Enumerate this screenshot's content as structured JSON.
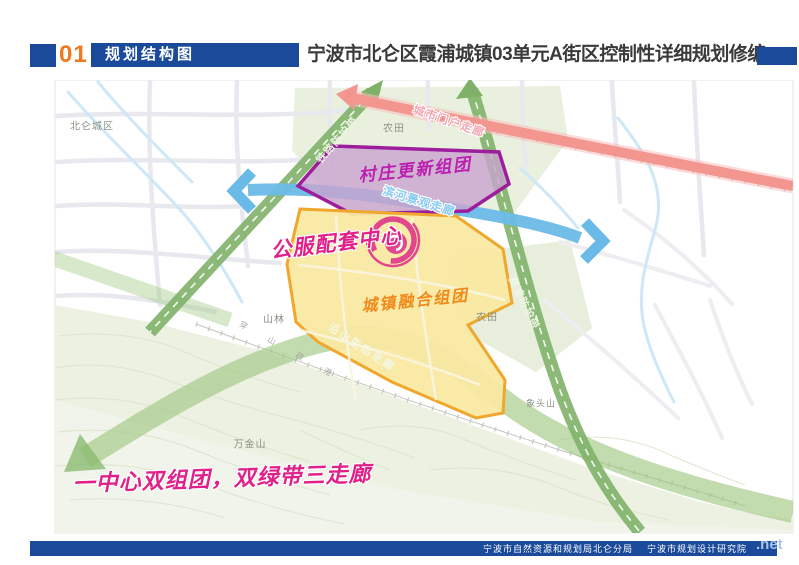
{
  "header": {
    "index_number": "01",
    "section_title": "规划结构图",
    "main_title": "宁波市北仑区霞浦城镇03单元A街区控制性详细规划修编"
  },
  "map": {
    "region_labels": {
      "beilun": "北仑城区",
      "farmland_north": "农田",
      "farmland_east": "农田",
      "forest": "山林",
      "wanjinshan": "万金山",
      "xiangtoushan": "象头山",
      "port_road": "穿山疏港"
    },
    "zones": {
      "village_renewal": {
        "label": "村庄更新组团",
        "fill": "#C9A2CE",
        "border": "#9C1E9C"
      },
      "town_integration": {
        "label": "城镇融合组团",
        "fill": "#F9E9A2",
        "border": "#F0A72E"
      },
      "public_service_center": {
        "label": "公服配套中心",
        "color": "#E0218A"
      }
    },
    "corridors": {
      "city_gateway": {
        "label": "城市门户走廊",
        "color": "#F2968F"
      },
      "riverside": {
        "label": "滨河景观走廊",
        "color": "#6ABAE8"
      },
      "railway_buffer": {
        "label": "铁路防护带",
        "color": "#7FB169"
      },
      "expressway_buffer": {
        "label": "高速防护带",
        "color": "#7FB169"
      },
      "mountain_eco": {
        "label": "沿山生态走廊",
        "color": "#9CC57E"
      }
    },
    "slogan": "一中心双组团，双绿带三走廊"
  },
  "footer": {
    "org_1": "宁波市自然资源和规划局北仑分局",
    "org_2": "宁波市规划设计研究院",
    "watermark": ".net"
  },
  "colors": {
    "brand_blue": "#1B4A9B",
    "index_orange": "#F07820",
    "slogan_pink": "#E0218A"
  }
}
